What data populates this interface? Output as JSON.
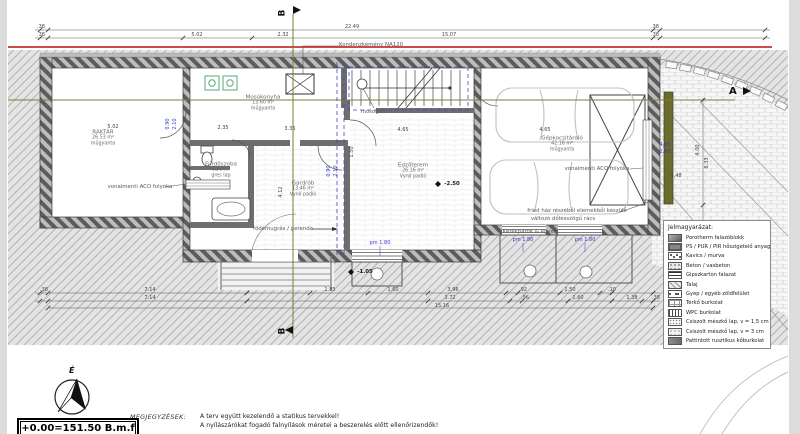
{
  "markers": {
    "b": "B",
    "a": "A",
    "north": "É"
  },
  "colors": {
    "boundary_red": "#c23232",
    "section_olive": "#7d7d33",
    "dim_blue": "#3a3acc",
    "equip_teal": "#55aa77",
    "hatch_gray": "#a6a6a6"
  },
  "rooms": [
    {
      "name": "RAKTÁR",
      "area": "26.53 m²",
      "floor": "műgyanta",
      "x": 103,
      "y": 138
    },
    {
      "name": "Mosókonyha",
      "area": "13.60 m²",
      "floor": "műgyanta",
      "x": 263,
      "y": 103
    },
    {
      "name": "Fürdőszoba",
      "area": "6.56 m²",
      "floor": "gres lap",
      "x": 221,
      "y": 170
    },
    {
      "name": "Gardrób",
      "area": "13.46 m²",
      "floor": "Vynil padló",
      "x": 303,
      "y": 189
    },
    {
      "name": "Edzőterem",
      "area": "26.16 m²",
      "floor": "Vynil padló",
      "x": 413,
      "y": 171
    },
    {
      "name": "Gépkocsitároló",
      "area": "42.16 m²",
      "floor": "műgyanta",
      "x": 562,
      "y": 144
    }
  ],
  "annotations": [
    {
      "t": "Kondenzkémény NA120",
      "x": 371,
      "y": 45
    },
    {
      "t": "vonalmenti ACO folyóka",
      "x": 140,
      "y": 187
    },
    {
      "t": "vonalmenti ACO folyóka",
      "x": 597,
      "y": 169
    },
    {
      "t": "mosogató",
      "x": 374,
      "y": 112
    },
    {
      "t": "födémugrás / gerenda",
      "x": 283,
      "y": 229
    },
    {
      "t": "fried ház részéből elemekből készülő",
      "x": 577,
      "y": 211
    },
    {
      "t": "változó dőlésszögű rács",
      "x": 563,
      "y": 219
    },
    {
      "t": "Kerékpárok & egyéb",
      "x": 530,
      "y": 232
    }
  ],
  "dims": [
    {
      "t": ".38",
      "x": 41,
      "y": 27
    },
    {
      "t": "22.49",
      "x": 352,
      "y": 27
    },
    {
      "t": ".38",
      "x": 655,
      "y": 27
    },
    {
      "t": ".38",
      "x": 41,
      "y": 35
    },
    {
      "t": "5.02",
      "x": 197,
      "y": 35
    },
    {
      "t": "2.32",
      "x": 283,
      "y": 35
    },
    {
      "t": "15.07",
      "x": 449,
      "y": 35
    },
    {
      "t": ".38",
      "x": 655,
      "y": 35
    },
    {
      "t": ".38",
      "x": 44,
      "y": 290
    },
    {
      "t": "7.14",
      "x": 150,
      "y": 290
    },
    {
      "t": "1.85",
      "x": 330,
      "y": 290
    },
    {
      "t": "1.60",
      "x": 393,
      "y": 290
    },
    {
      "t": "3.96",
      "x": 453,
      "y": 290
    },
    {
      "t": ".92",
      "x": 523,
      "y": 290
    },
    {
      "t": "1.50",
      "x": 570,
      "y": 290
    },
    {
      "t": ".10",
      "x": 612,
      "y": 290
    },
    {
      "t": "7.14",
      "x": 150,
      "y": 298
    },
    {
      "t": "3.72",
      "x": 450,
      "y": 298
    },
    {
      "t": ".96",
      "x": 525,
      "y": 298
    },
    {
      "t": "1.60",
      "x": 578,
      "y": 298
    },
    {
      "t": "1.38",
      "x": 632,
      "y": 298
    },
    {
      "t": ".38",
      "x": 656,
      "y": 298
    },
    {
      "t": "15.16",
      "x": 442,
      "y": 306
    },
    {
      "t": "5.02",
      "x": 113,
      "y": 127
    },
    {
      "t": "2.35",
      "x": 223,
      "y": 128
    },
    {
      "t": "3.35",
      "x": 290,
      "y": 129
    },
    {
      "t": "4.65",
      "x": 403,
      "y": 130
    },
    {
      "t": "4.65",
      "x": 545,
      "y": 130
    },
    {
      "t": "1.50",
      "x": 352,
      "y": 152,
      "rot": 1
    },
    {
      "t": "4.12",
      "x": 281,
      "y": 192,
      "rot": 1
    },
    {
      "t": "1.48",
      "x": 676,
      "y": 176
    },
    {
      "t": "4.00",
      "x": 698,
      "y": 150,
      "rot": 1
    },
    {
      "t": "6.33",
      "x": 707,
      "y": 163,
      "rot": 1
    }
  ],
  "blue_labels": [
    {
      "t": "pm 1.80",
      "x": 380,
      "y": 243
    },
    {
      "t": "pm 1.80",
      "x": 523,
      "y": 240
    },
    {
      "t": "pm 1.80",
      "x": 585,
      "y": 240
    },
    {
      "t": "4.65",
      "x": 665,
      "y": 145
    },
    {
      "t": "2.80",
      "x": 665,
      "y": 152
    },
    {
      "t": "0.90",
      "x": 168,
      "y": 124,
      "rot": 1
    },
    {
      "t": "2.10",
      "x": 175,
      "y": 124,
      "rot": 1
    },
    {
      "t": "0.90",
      "x": 329,
      "y": 171,
      "rot": 1
    },
    {
      "t": "2.10",
      "x": 336,
      "y": 171,
      "rot": 1
    }
  ],
  "levels": [
    {
      "t": "-2.50",
      "x": 452,
      "y": 184
    },
    {
      "t": "-1.05",
      "x": 365,
      "y": 272
    },
    {
      "t": "-1.05",
      "x": 754,
      "y": 267
    }
  ],
  "legend": {
    "title": "Jelmagyarázat:",
    "items": [
      {
        "label": "Porotherm falazóblokk",
        "swatch": "porotherm"
      },
      {
        "label": "PS / PUR / PIR hőszigetelő anyag",
        "swatch": "insulation"
      },
      {
        "label": "Kavics / murva",
        "swatch": "kavics"
      },
      {
        "label": "Beton / vasbeton",
        "swatch": "beton"
      },
      {
        "label": "Gipszkarton falazat",
        "swatch": "gipszkarton"
      },
      {
        "label": "Talaj",
        "swatch": "talaj"
      },
      {
        "label": "Gyep / egyéb zöldfelület",
        "swatch": "gyep"
      },
      {
        "label": "Térkő burkolat",
        "swatch": "terko"
      },
      {
        "label": "WPC burkolat",
        "swatch": "wpc"
      },
      {
        "label": "Csiszolt mészkő lap, v = 1,5 cm",
        "swatch": "meszko15"
      },
      {
        "label": "Csiszolt mészkő lap, v = 3 cm",
        "swatch": "meszko3"
      },
      {
        "label": "Pattintott rusztikus kőburkolat",
        "swatch": "pattintott"
      }
    ]
  },
  "notes": {
    "heading": "MEGJEGYZÉSEK:",
    "lines": [
      "A terv együtt kezelendő a statikus tervekkel!",
      "A nyílászárókat fogadó falnyílások méretei a beszerelés előtt ellenőrizendők!"
    ]
  },
  "datum": {
    "text": "+0.00=151.50 B.m.f"
  }
}
